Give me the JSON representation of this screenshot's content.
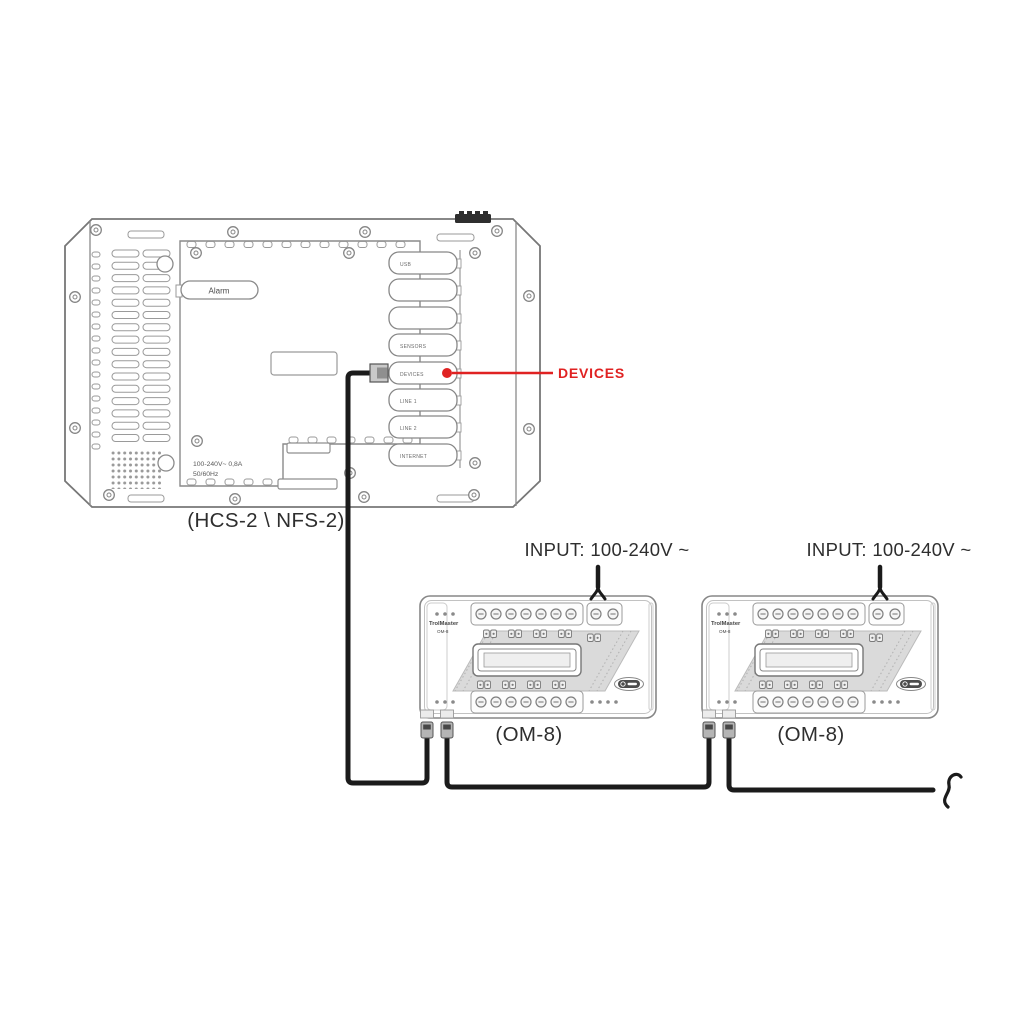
{
  "controller": {
    "caption": "(HCS-2 \\ NFS-2)",
    "alarm_label": "Alarm",
    "power_rating": {
      "line1": "100-240V~  0,8A",
      "line2": "50/60Hz"
    },
    "ports": [
      {
        "label": "USB"
      },
      {
        "label": ""
      },
      {
        "label": ""
      },
      {
        "label": "SENSORS"
      },
      {
        "label": "DEVICES"
      },
      {
        "label": "LINE 1"
      },
      {
        "label": "LINE 2"
      },
      {
        "label": "INTERNET"
      }
    ],
    "callout": {
      "label": "DEVICES"
    }
  },
  "modules": [
    {
      "caption": "(OM-8)",
      "input_label": "INPUT: 100-240V ~"
    },
    {
      "caption": "(OM-8)",
      "input_label": "INPUT: 100-240V ~"
    }
  ],
  "module_face": {
    "brand": "TrolMaster",
    "model": "OM-8"
  },
  "colors": {
    "accent_red": "#e02222",
    "outline_gray": "#878787",
    "cable_black": "#1b1b1b",
    "band_gray": "#dadada"
  }
}
